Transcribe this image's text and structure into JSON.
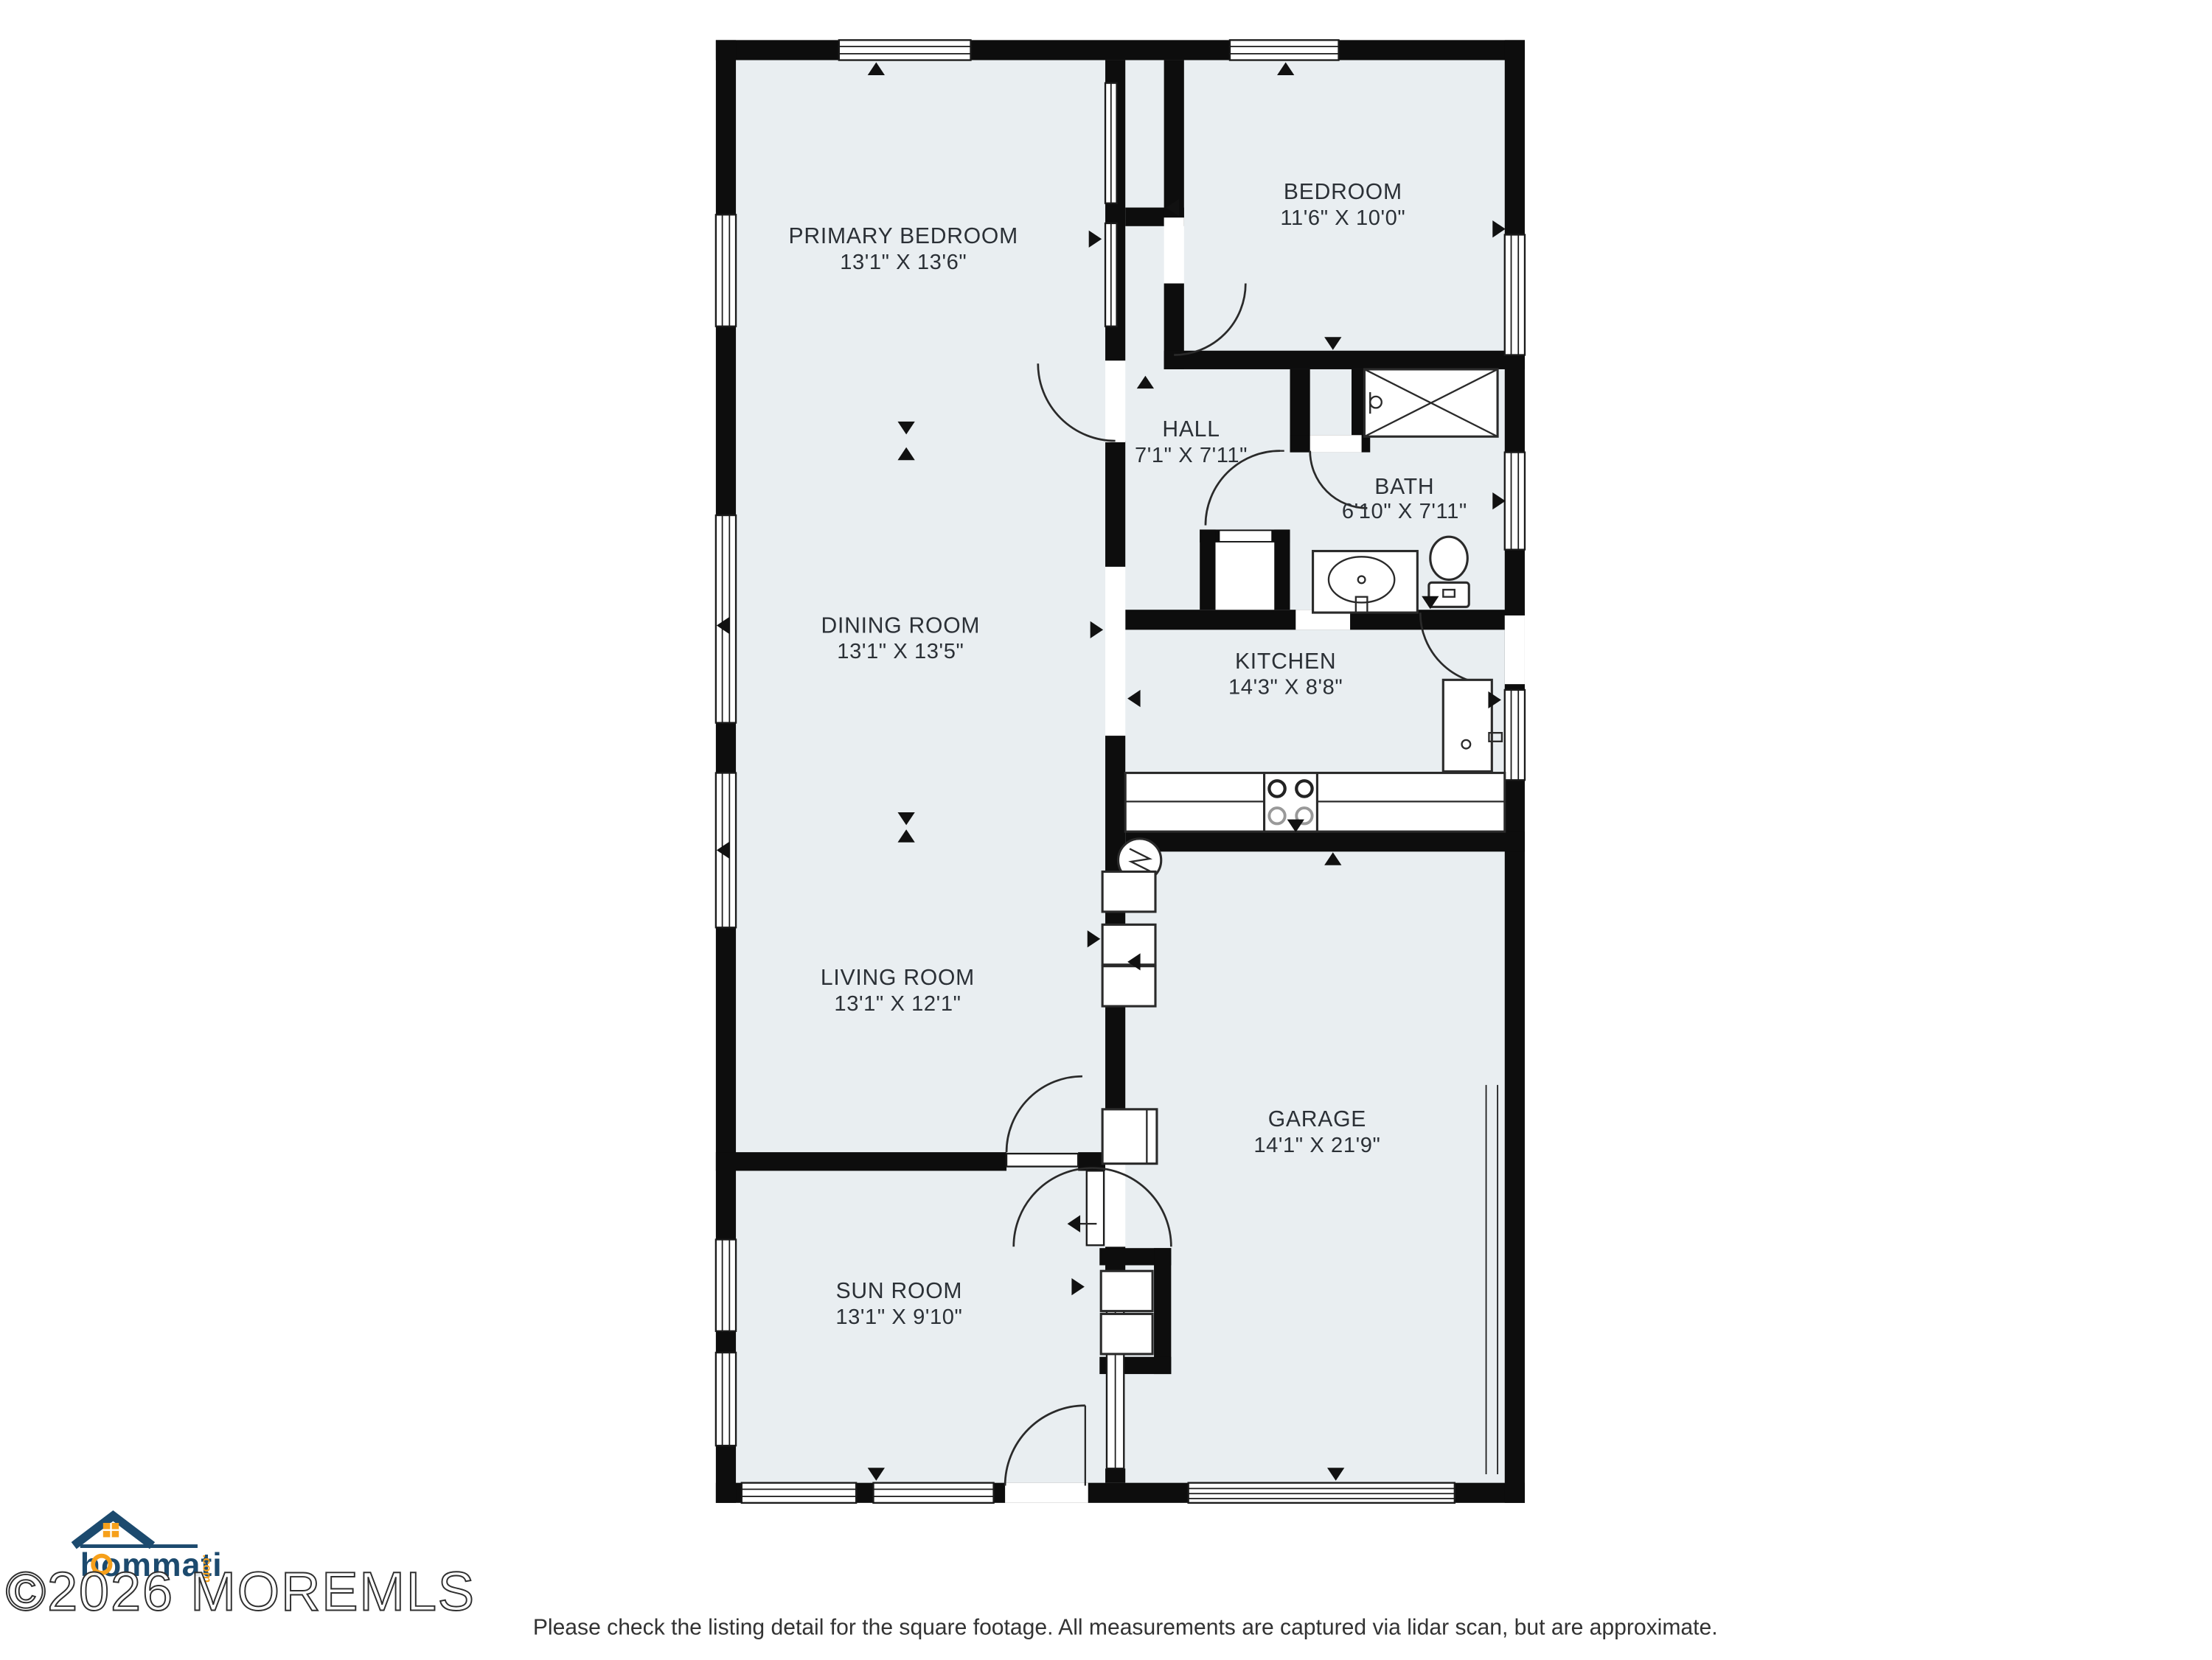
{
  "plan": {
    "rooms": [
      {
        "name": "PRIMARY BEDROOM",
        "dims": "13'1\" X 13'6\""
      },
      {
        "name": "BEDROOM",
        "dims": "11'6\" X 10'0\""
      },
      {
        "name": "HALL",
        "dims": "7'1\" X 7'11\""
      },
      {
        "name": "BATH",
        "dims": "6'10\" X 7'11\""
      },
      {
        "name": "DINING ROOM",
        "dims": "13'1\" X 13'5\""
      },
      {
        "name": "KITCHEN",
        "dims": "14'3\" X 8'8\""
      },
      {
        "name": "LIVING ROOM",
        "dims": "13'1\" X 12'1\""
      },
      {
        "name": "GARAGE",
        "dims": "14'1\" X 21'9\""
      },
      {
        "name": "SUN ROOM",
        "dims": "13'1\" X 9'10\""
      }
    ],
    "icons": [
      "bathtub-icon",
      "toilet-icon",
      "sink-icon",
      "stove-icon",
      "refrigerator-icon",
      "water-heater-icon",
      "garage-door-icon",
      "window-icon",
      "door-arc-icon"
    ]
  },
  "footer": {
    "watermark": "©2026 MOREMLS",
    "logo_text": "hommati",
    "logo_tld": ".com",
    "disclaimer": "Please check the listing detail for the square footage. All measurements are captured via lidar scan, but are approximate."
  },
  "colors": {
    "floor": "#e9eef1",
    "wall": "#0d0d0d",
    "line": "#2a2a2a",
    "label": "#2b3036",
    "logo_navy": "#1c4a6e",
    "logo_orange": "#f6a01b"
  }
}
